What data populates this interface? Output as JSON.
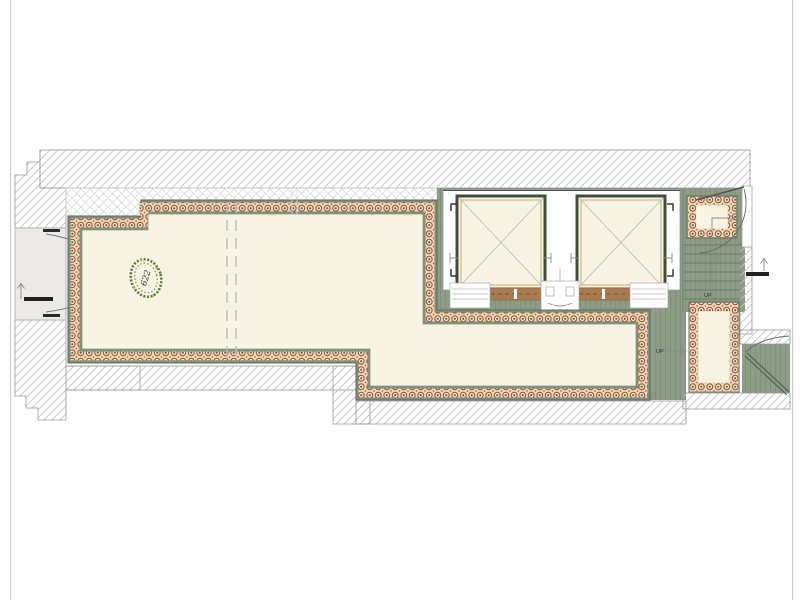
{
  "plan": {
    "title": "corridor-and-elevator-lobby-floor-plan",
    "room_label": "622",
    "labels": {
      "up": "UP"
    },
    "colors": {
      "floor_cream": "#f7f4e4",
      "band_green": "#7f8f7a",
      "lobby_green": "#8d9c85",
      "tile_rust": "#aa5230",
      "shaft_wall": "#3e4e3c",
      "gold_trim": "#c9b272",
      "sill_brown": "#a97c4f",
      "hatch_gray": "#c3c3c3",
      "vestibule_gray": "#eceae6",
      "frame_gray": "#cccccc"
    }
  }
}
